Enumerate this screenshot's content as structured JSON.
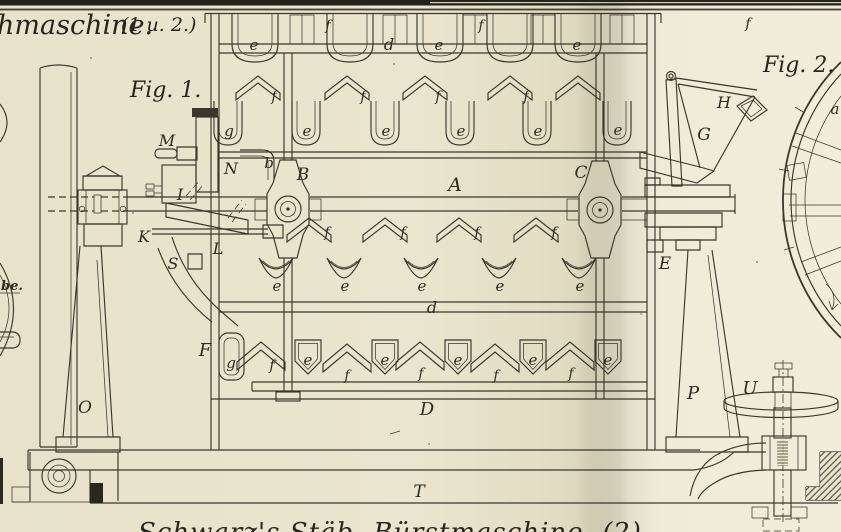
{
  "plate": {
    "title_fragment": "hmaschine.",
    "title_number": "(1 u. 2.)",
    "fig1_label": "Fig. 1.",
    "fig2_label": "Fig. 2.",
    "caption_fragment": "Schwarz's Stäb- Bürstmaschine. (2)",
    "edge_fragment": "be.",
    "paper_color": "#eae5ce",
    "ink_color": "#3b372c"
  },
  "part_labels": {
    "A": "A",
    "B": "B",
    "C": "C",
    "D": "D",
    "E": "E",
    "F": "F",
    "G": "G",
    "H": "H",
    "I": "I",
    "K": "K",
    "L": "L",
    "M": "M",
    "N": "N",
    "O": "O",
    "P": "P",
    "S": "S",
    "T": "T",
    "U": "U",
    "a": "a",
    "b": "b",
    "d": "d",
    "e": "e",
    "f": "f",
    "g": "g"
  }
}
